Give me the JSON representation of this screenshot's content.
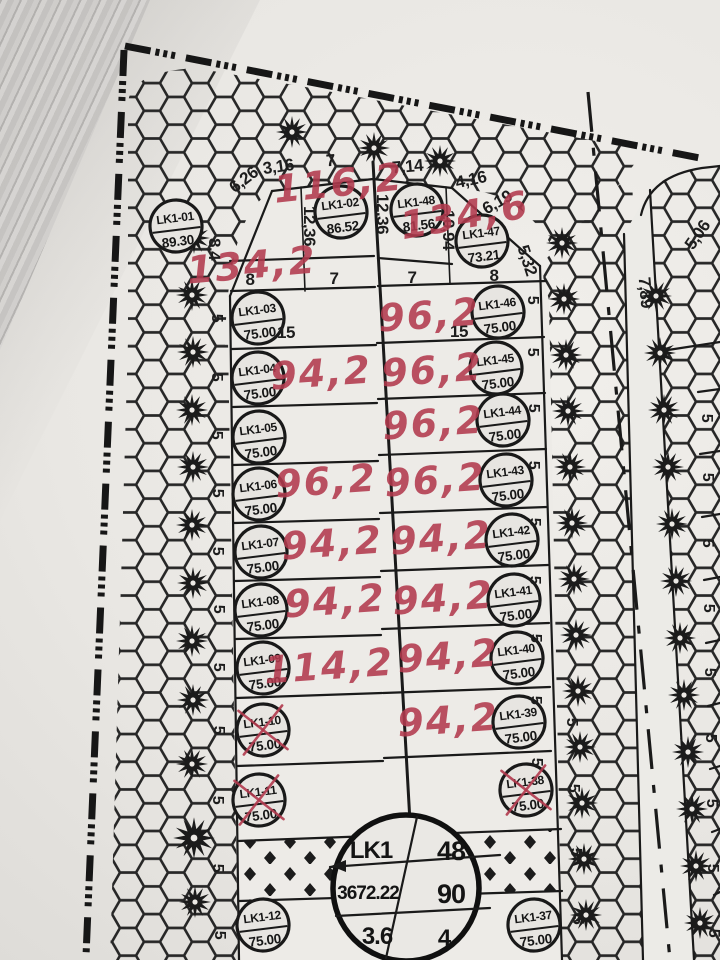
{
  "block_stamp": {
    "code": "LK1",
    "top_right": "48",
    "mid_left": "3672.22",
    "mid_right": "90",
    "bottom_left": "3.6",
    "bottom_right": "4"
  },
  "lots": [
    {
      "id": "LK1-01",
      "area": "89.30",
      "crossed": false
    },
    {
      "id": "LK1-02",
      "area": "86.52",
      "crossed": false
    },
    {
      "id": "LK1-48",
      "area": "81.56",
      "crossed": false
    },
    {
      "id": "LK1-47",
      "area": "73.21",
      "crossed": false
    },
    {
      "id": "LK1-03",
      "area": "75.00",
      "crossed": false
    },
    {
      "id": "LK1-04",
      "area": "75.00",
      "crossed": false
    },
    {
      "id": "LK1-05",
      "area": "75.00",
      "crossed": false
    },
    {
      "id": "LK1-06",
      "area": "75.00",
      "crossed": false
    },
    {
      "id": "LK1-07",
      "area": "75.00",
      "crossed": false
    },
    {
      "id": "LK1-08",
      "area": "75.00",
      "crossed": false
    },
    {
      "id": "LK1-09",
      "area": "75.00",
      "crossed": false
    },
    {
      "id": "LK1-10",
      "area": "75.00",
      "crossed": true
    },
    {
      "id": "LK1-11",
      "area": "75.00",
      "crossed": true
    },
    {
      "id": "LK1-12",
      "area": "75.00",
      "crossed": false
    },
    {
      "id": "LK1-46",
      "area": "75.00",
      "crossed": false
    },
    {
      "id": "LK1-45",
      "area": "75.00",
      "crossed": false
    },
    {
      "id": "LK1-44",
      "area": "75.00",
      "crossed": false
    },
    {
      "id": "LK1-43",
      "area": "75.00",
      "crossed": false
    },
    {
      "id": "LK1-42",
      "area": "75.00",
      "crossed": false
    },
    {
      "id": "LK1-41",
      "area": "75.00",
      "crossed": false
    },
    {
      "id": "LK1-40",
      "area": "75.00",
      "crossed": false
    },
    {
      "id": "LK1-39",
      "area": "75.00",
      "crossed": false
    },
    {
      "id": "LK1-38",
      "area": "75.00",
      "crossed": true
    },
    {
      "id": "LK1-37",
      "area": "75.00",
      "crossed": false
    }
  ],
  "red_notes": [
    "116,2",
    "134,2",
    "134,6",
    "96,2",
    "94,2",
    "96,2",
    "96,2",
    "96,2",
    "96,2",
    "94,2",
    "94,2",
    "94,2",
    "94,2",
    "114,2",
    "94,2",
    "94,2"
  ],
  "dimensions": [
    "6,26",
    "3,16",
    "7",
    "7,14",
    "4,16",
    "6,19",
    "12,36",
    "12,36",
    "10,94",
    "5,32",
    "8,4",
    "8",
    "7",
    "7",
    "8",
    "15",
    "15",
    "5,06",
    "7,89"
  ],
  "side_label": "5"
}
